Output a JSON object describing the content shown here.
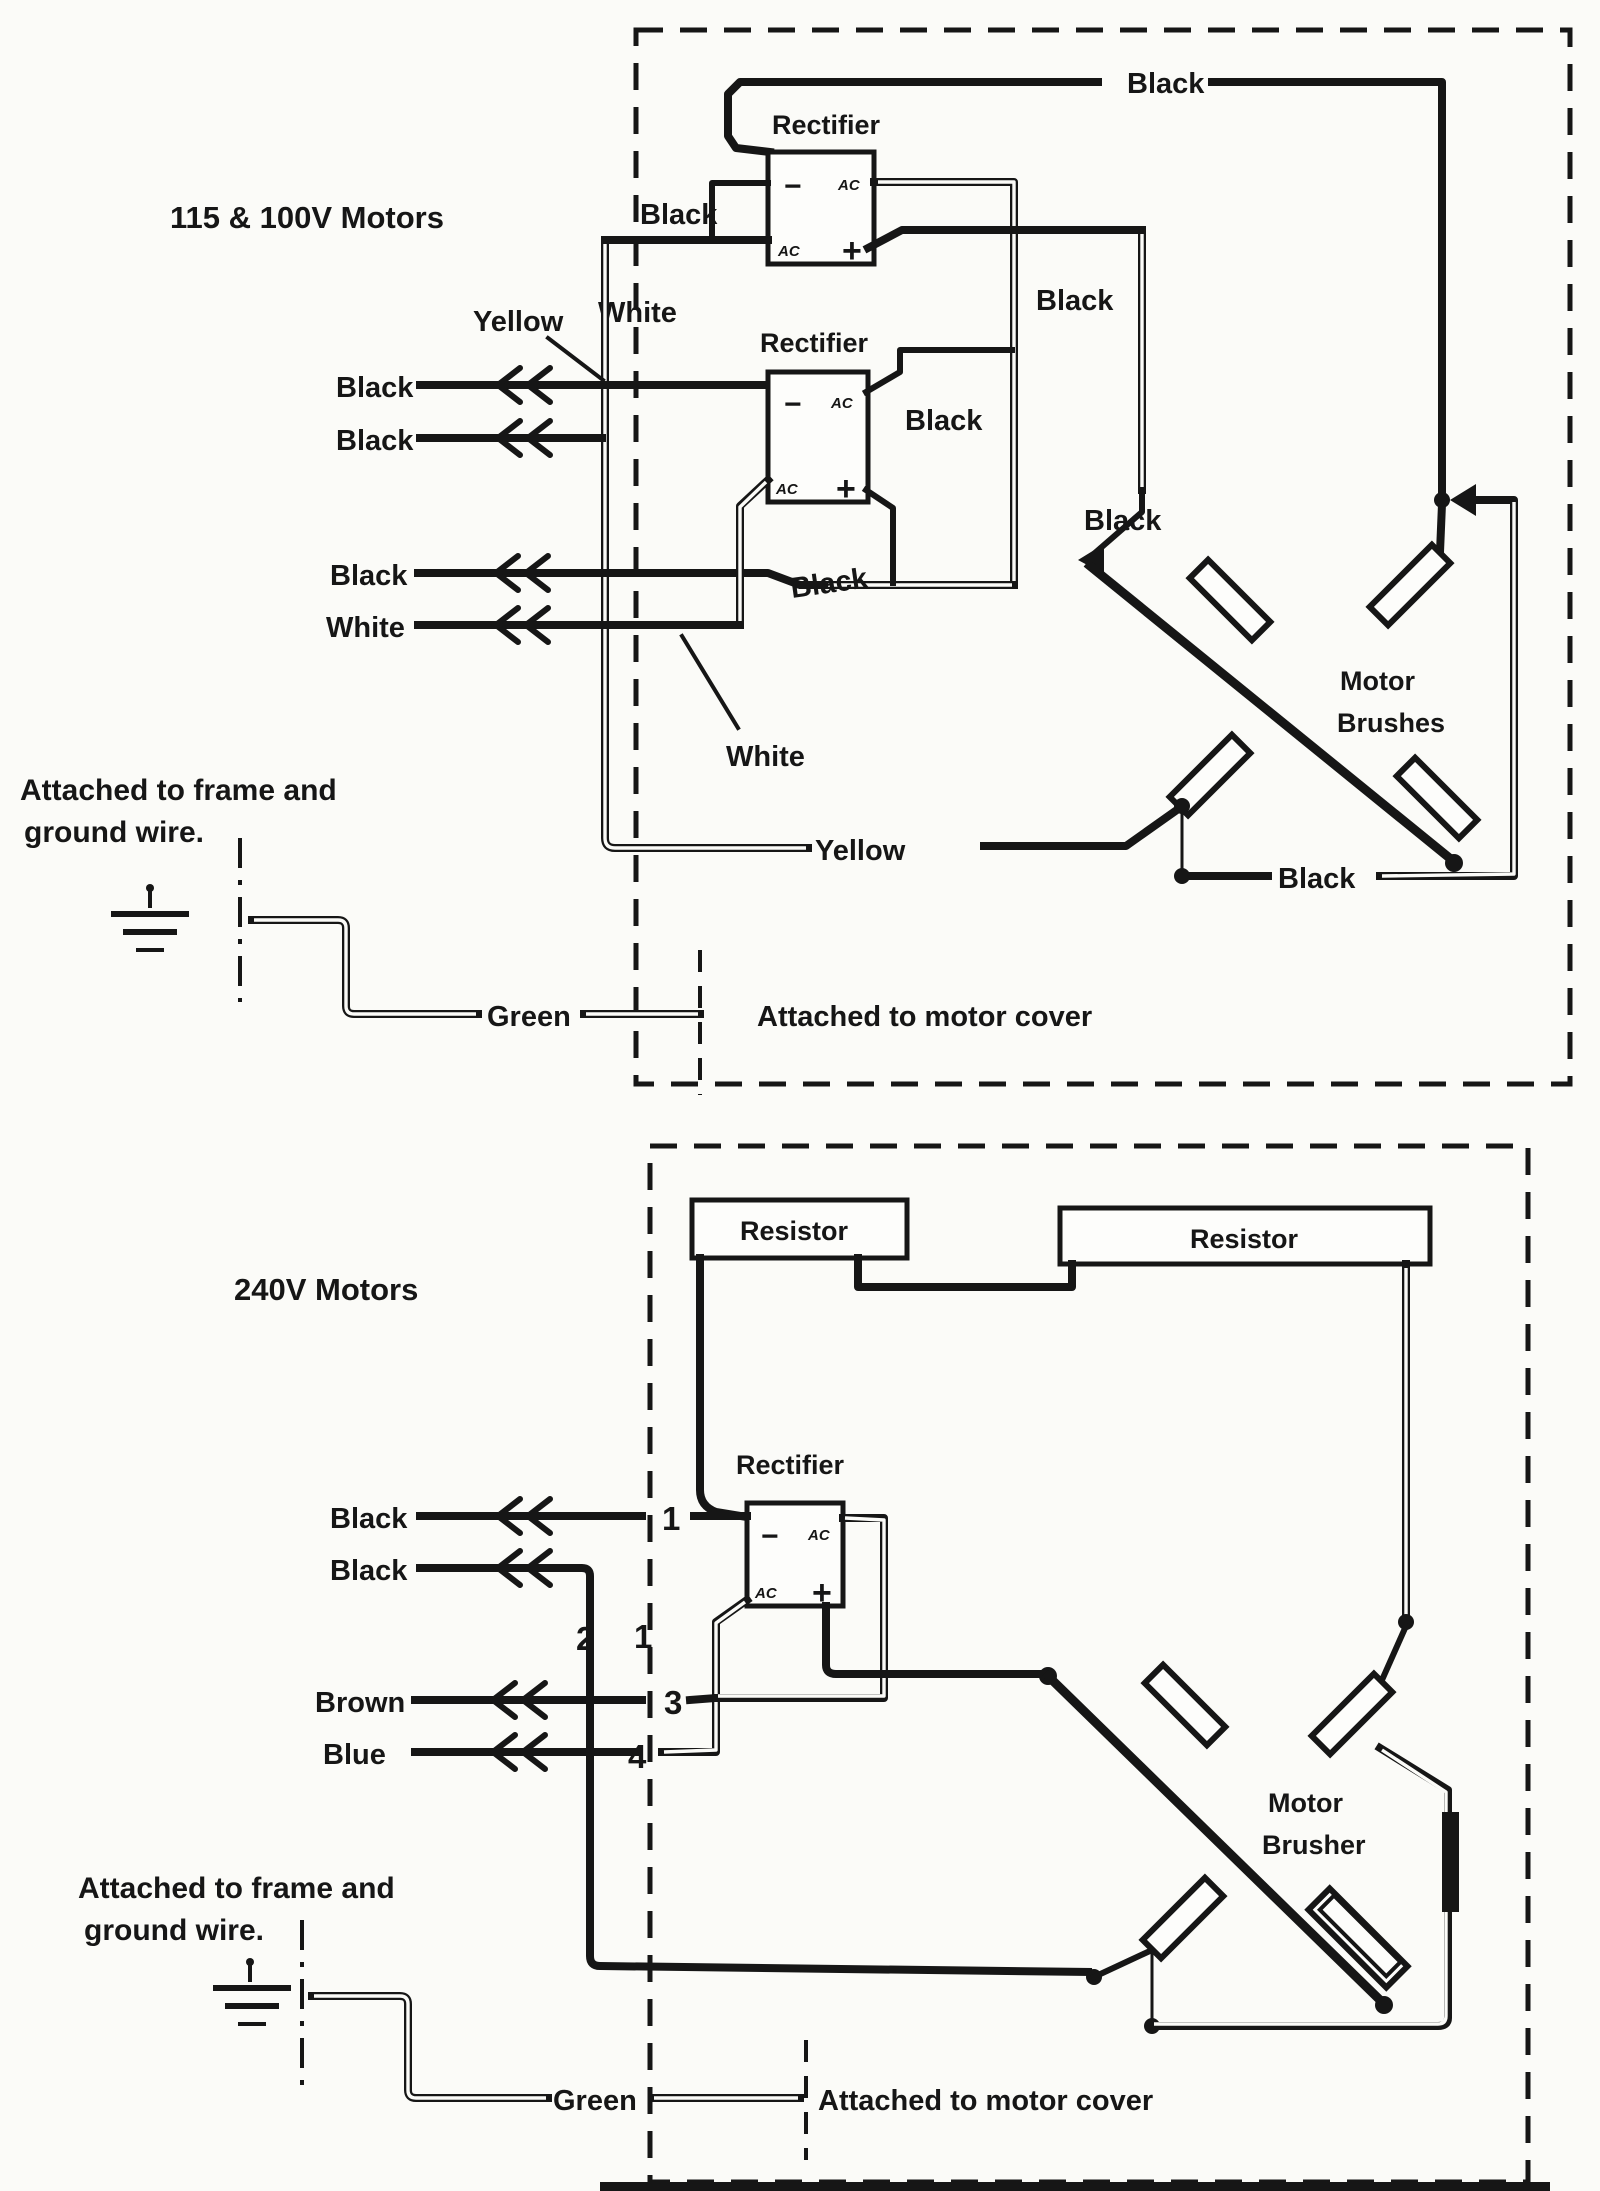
{
  "colors": {
    "ink": "#161616",
    "paper": "#fbfbf8"
  },
  "sym": {
    "minus": "−",
    "plus": "+",
    "ac": "AC"
  },
  "top": {
    "title": "115 & 100V Motors",
    "rectifier1": "Rectifier",
    "rectifier2": "Rectifier",
    "black_top": "Black",
    "black_r1_left": "Black",
    "white_left": "White",
    "yellow_top": "Yellow",
    "row1": "Black",
    "row2": "Black",
    "row3": "Black",
    "row4": "White",
    "black_r1_right": "Black",
    "black_r2_right": "Black",
    "black_mid": "Black",
    "black_brush": "Black",
    "motor_line1": "Motor",
    "motor_line2": "Brushes",
    "white_pointer": "White",
    "yellow_bottom": "Yellow",
    "black_bottom": "Black",
    "frame1": "Attached to frame and",
    "frame2": "ground wire.",
    "green": "Green",
    "cover": "Attached to motor cover"
  },
  "bottom": {
    "title": "240V Motors",
    "resistor_left": "Resistor",
    "resistor_right": "Resistor",
    "rectifier": "Rectifier",
    "row1": "Black",
    "row2": "Black",
    "row3": "Brown",
    "row4": "Blue",
    "n1": "1",
    "n2": "2",
    "n1b": "1",
    "n3": "3",
    "n4": "4",
    "motor_line1": "Motor",
    "motor_line2": "Brusher",
    "frame1": "Attached to frame and",
    "frame2": "ground wire.",
    "green": "Green",
    "cover": "Attached to motor cover"
  }
}
